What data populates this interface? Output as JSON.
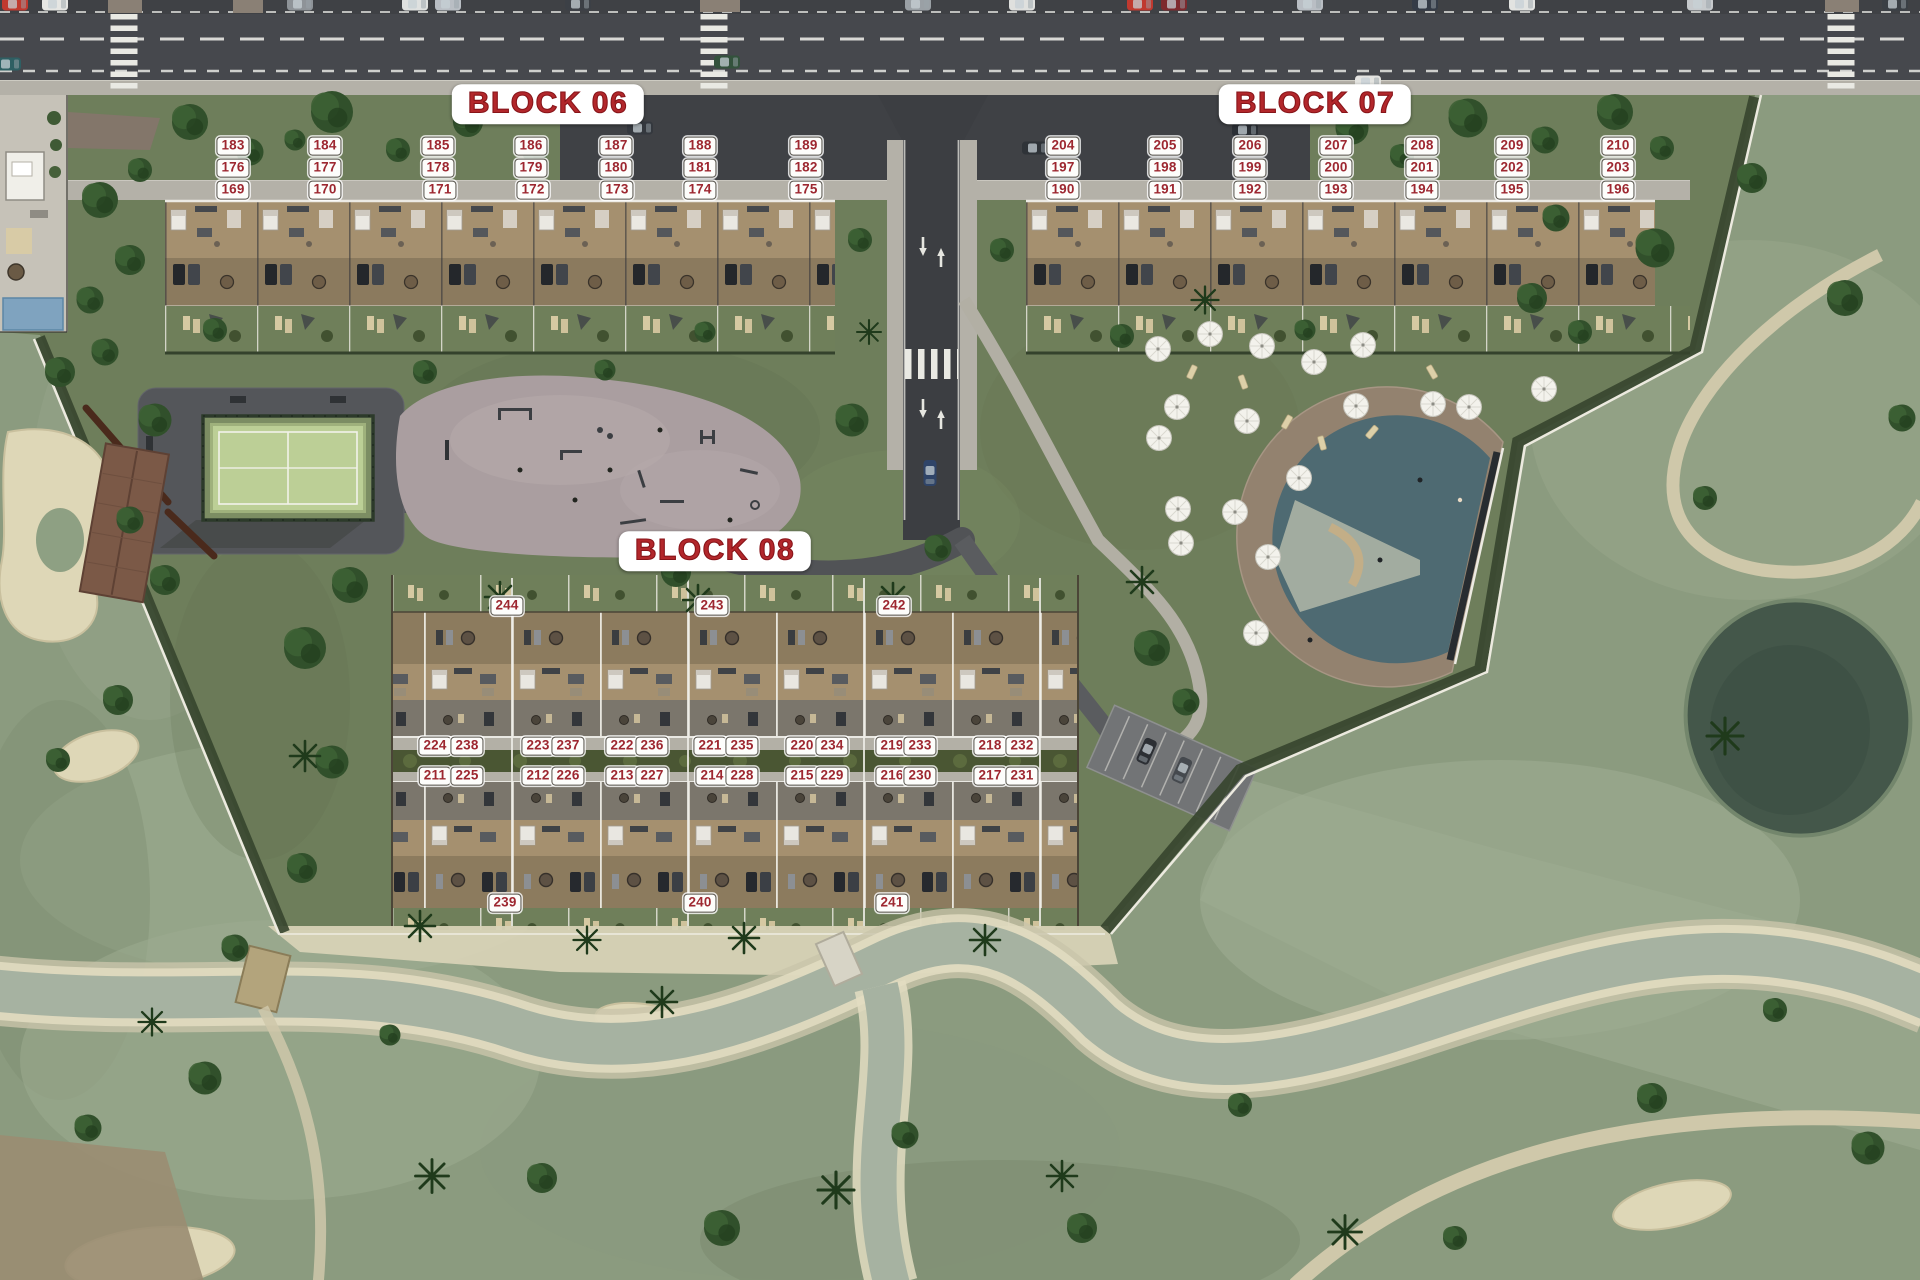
{
  "colors": {
    "label_text": "#9d2730",
    "label_bg": "#fdfdfb",
    "title_text": "#b2272b",
    "asphalt": "#46484d",
    "sidewalk": "#b4b1a8",
    "site_grass": "#6e7e5b",
    "golf_grass": "#8b9b7f",
    "sand": "#ddd6b6",
    "stream_water": "#a9b5a4",
    "pool_water": "#4e6a72",
    "pool_deck": "#93826f",
    "roof_wood": "#8c7b5e",
    "padel_court": "#bccf96",
    "playground_paving": "#aa9ea0",
    "pond": "#44574a"
  },
  "blocks": [
    {
      "name": "BLOCK 06",
      "title": {
        "x": 548,
        "y": 104
      },
      "units": [
        {
          "n": "183",
          "x": 233,
          "y": 146
        },
        {
          "n": "184",
          "x": 325,
          "y": 146
        },
        {
          "n": "185",
          "x": 438,
          "y": 146
        },
        {
          "n": "186",
          "x": 531,
          "y": 146
        },
        {
          "n": "187",
          "x": 616,
          "y": 146
        },
        {
          "n": "188",
          "x": 700,
          "y": 146
        },
        {
          "n": "189",
          "x": 806,
          "y": 146
        },
        {
          "n": "176",
          "x": 233,
          "y": 168
        },
        {
          "n": "177",
          "x": 325,
          "y": 168
        },
        {
          "n": "178",
          "x": 438,
          "y": 168
        },
        {
          "n": "179",
          "x": 531,
          "y": 168
        },
        {
          "n": "180",
          "x": 616,
          "y": 168
        },
        {
          "n": "181",
          "x": 700,
          "y": 168
        },
        {
          "n": "182",
          "x": 806,
          "y": 168
        },
        {
          "n": "169",
          "x": 233,
          "y": 190
        },
        {
          "n": "170",
          "x": 325,
          "y": 190
        },
        {
          "n": "171",
          "x": 440,
          "y": 190
        },
        {
          "n": "172",
          "x": 533,
          "y": 190
        },
        {
          "n": "173",
          "x": 617,
          "y": 190
        },
        {
          "n": "174",
          "x": 700,
          "y": 190
        },
        {
          "n": "175",
          "x": 806,
          "y": 190
        }
      ]
    },
    {
      "name": "BLOCK 07",
      "title": {
        "x": 1315,
        "y": 104
      },
      "units": [
        {
          "n": "204",
          "x": 1063,
          "y": 146
        },
        {
          "n": "205",
          "x": 1165,
          "y": 146
        },
        {
          "n": "206",
          "x": 1250,
          "y": 146
        },
        {
          "n": "207",
          "x": 1336,
          "y": 146
        },
        {
          "n": "208",
          "x": 1422,
          "y": 146
        },
        {
          "n": "209",
          "x": 1512,
          "y": 146
        },
        {
          "n": "210",
          "x": 1618,
          "y": 146
        },
        {
          "n": "197",
          "x": 1063,
          "y": 168
        },
        {
          "n": "198",
          "x": 1165,
          "y": 168
        },
        {
          "n": "199",
          "x": 1250,
          "y": 168
        },
        {
          "n": "200",
          "x": 1336,
          "y": 168
        },
        {
          "n": "201",
          "x": 1422,
          "y": 168
        },
        {
          "n": "202",
          "x": 1512,
          "y": 168
        },
        {
          "n": "203",
          "x": 1618,
          "y": 168
        },
        {
          "n": "190",
          "x": 1063,
          "y": 190
        },
        {
          "n": "191",
          "x": 1165,
          "y": 190
        },
        {
          "n": "192",
          "x": 1250,
          "y": 190
        },
        {
          "n": "193",
          "x": 1336,
          "y": 190
        },
        {
          "n": "194",
          "x": 1422,
          "y": 190
        },
        {
          "n": "195",
          "x": 1512,
          "y": 190
        },
        {
          "n": "196",
          "x": 1618,
          "y": 190
        }
      ]
    },
    {
      "name": "BLOCK 08",
      "title": {
        "x": 715,
        "y": 551
      },
      "units": [
        {
          "n": "244",
          "x": 507,
          "y": 606
        },
        {
          "n": "243",
          "x": 712,
          "y": 606
        },
        {
          "n": "242",
          "x": 894,
          "y": 606
        },
        {
          "n": "224",
          "x": 435,
          "y": 746
        },
        {
          "n": "238",
          "x": 467,
          "y": 746
        },
        {
          "n": "223",
          "x": 538,
          "y": 746
        },
        {
          "n": "237",
          "x": 568,
          "y": 746
        },
        {
          "n": "222",
          "x": 622,
          "y": 746
        },
        {
          "n": "236",
          "x": 652,
          "y": 746
        },
        {
          "n": "221",
          "x": 710,
          "y": 746
        },
        {
          "n": "235",
          "x": 742,
          "y": 746
        },
        {
          "n": "220",
          "x": 802,
          "y": 746
        },
        {
          "n": "234",
          "x": 832,
          "y": 746
        },
        {
          "n": "219",
          "x": 892,
          "y": 746
        },
        {
          "n": "233",
          "x": 920,
          "y": 746
        },
        {
          "n": "218",
          "x": 990,
          "y": 746
        },
        {
          "n": "232",
          "x": 1022,
          "y": 746
        },
        {
          "n": "211",
          "x": 435,
          "y": 776
        },
        {
          "n": "225",
          "x": 467,
          "y": 776
        },
        {
          "n": "212",
          "x": 538,
          "y": 776
        },
        {
          "n": "226",
          "x": 568,
          "y": 776
        },
        {
          "n": "213",
          "x": 622,
          "y": 776
        },
        {
          "n": "227",
          "x": 652,
          "y": 776
        },
        {
          "n": "214",
          "x": 712,
          "y": 776
        },
        {
          "n": "228",
          "x": 742,
          "y": 776
        },
        {
          "n": "215",
          "x": 802,
          "y": 776
        },
        {
          "n": "229",
          "x": 832,
          "y": 776
        },
        {
          "n": "216",
          "x": 892,
          "y": 776
        },
        {
          "n": "230",
          "x": 920,
          "y": 776
        },
        {
          "n": "217",
          "x": 990,
          "y": 776
        },
        {
          "n": "231",
          "x": 1022,
          "y": 776
        },
        {
          "n": "239",
          "x": 505,
          "y": 903
        },
        {
          "n": "240",
          "x": 700,
          "y": 903
        },
        {
          "n": "241",
          "x": 892,
          "y": 903
        }
      ]
    }
  ]
}
